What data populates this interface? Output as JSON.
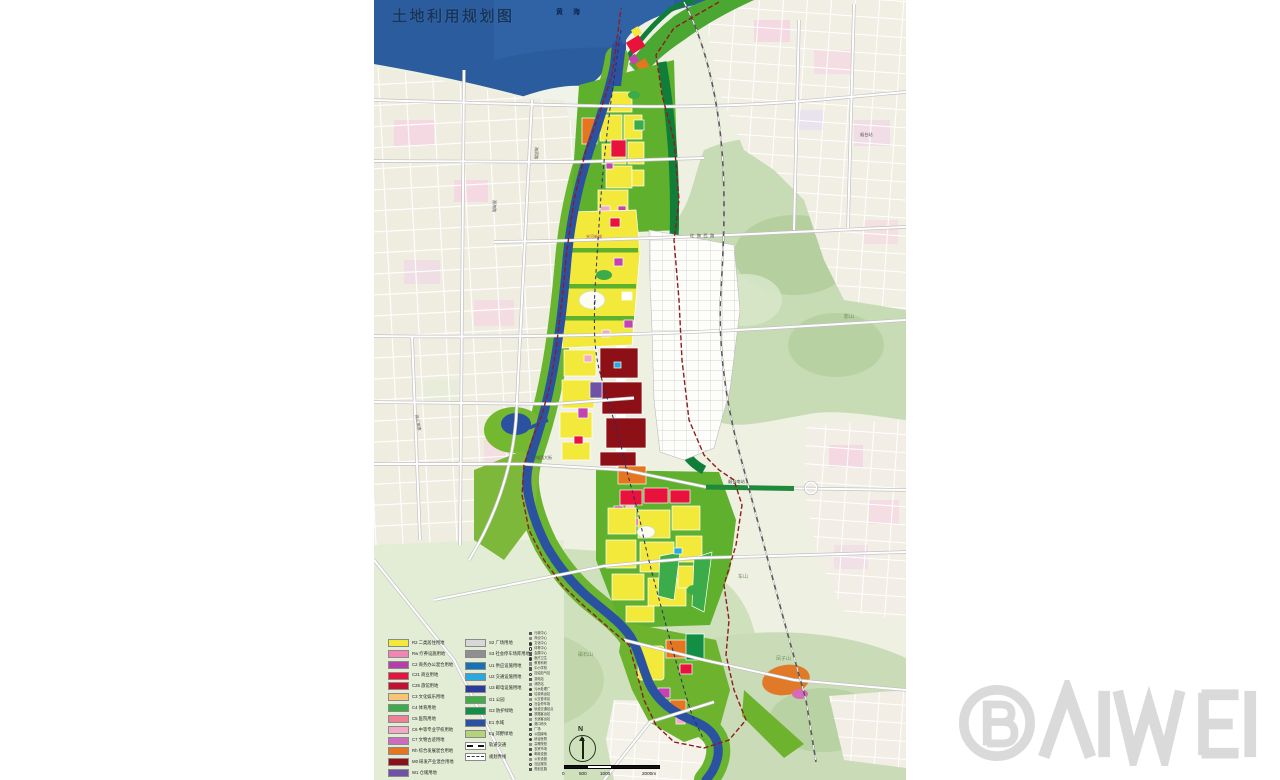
{
  "title": "土地利用规划图",
  "watermark_text": "BAIWEI",
  "north_label": "N",
  "scale": {
    "ticks": [
      {
        "label": "0",
        "left": 6
      },
      {
        "label": "500",
        "left": 23
      },
      {
        "label": "1000",
        "left": 44
      },
      {
        "label": "2000m",
        "left": 86
      }
    ]
  },
  "colors": {
    "sea": "#2b5c9e",
    "river": "#2a52a0",
    "park_green": "#63b22e",
    "boundary_line": "#8f1d1d",
    "watermark_gray": "#d9d9d9"
  },
  "legend": {
    "col1": [
      {
        "label": "R2 二类居住用地",
        "color": "#f2e93b"
      },
      {
        "label": "Rw 疗养设施用地",
        "color": "#f285b4"
      },
      {
        "label": "C2 商务办公混合用地",
        "color": "#b53fa8"
      },
      {
        "label": "C21 商业用地",
        "color": "#e8123d"
      },
      {
        "label": "C25 旅馆用地",
        "color": "#c50f31"
      },
      {
        "label": "C3 文化娱乐用地",
        "color": "#f8c577"
      },
      {
        "label": "C4 体育用地",
        "color": "#3cab49"
      },
      {
        "label": "C5 医院用地",
        "color": "#ec8096"
      },
      {
        "label": "C6 中等专业学校用地",
        "color": "#f2a9c6"
      },
      {
        "label": "C7 文物古迹用地",
        "color": "#cf6bbf"
      },
      {
        "label": "Rh 综合发展混合用地",
        "color": "#e5761f"
      },
      {
        "label": "M0 研发产业混合用地",
        "color": "#8c1016"
      },
      {
        "label": "W1 仓储用地",
        "color": "#6f51a5"
      }
    ],
    "col2": [
      {
        "label": "S2 广场用地",
        "color": "#d8d8d8"
      },
      {
        "label": "S3 社会停车场库用地",
        "color": "#8f8f8f"
      },
      {
        "label": "U1 供应设施用地",
        "color": "#1573b5"
      },
      {
        "label": "U2 交通设施用地",
        "color": "#2aa8e0"
      },
      {
        "label": "U3 邮电设施用地",
        "color": "#2c3a99"
      },
      {
        "label": "G1 公园",
        "color": "#3fae49"
      },
      {
        "label": "G2 防护绿地",
        "color": "#128f45"
      },
      {
        "label": "E1 水域",
        "color": "#2a52a0"
      },
      {
        "label": "Eg 郊野绿地",
        "color": "#b5d378"
      },
      {
        "label": "轨道交通",
        "type": "rail"
      },
      {
        "label": "规划界线",
        "type": "bound"
      }
    ],
    "col3": [
      {
        "label": "行政中心",
        "shape": "sq"
      },
      {
        "label": "商业中心",
        "shape": "sq-gray"
      },
      {
        "label": "文化中心",
        "shape": "ci"
      },
      {
        "label": "体育中心",
        "shape": "ci-open"
      },
      {
        "label": "会展中心",
        "shape": "sq"
      },
      {
        "label": "医疗卫生",
        "shape": "ci"
      },
      {
        "label": "教育科研",
        "shape": "sq-gray"
      },
      {
        "label": "中小学校",
        "shape": "sq"
      },
      {
        "label": "加油加气站",
        "shape": "ci-open"
      },
      {
        "label": "变电站",
        "shape": "sq"
      },
      {
        "label": "消防站",
        "shape": "sq-gray"
      },
      {
        "label": "污水处理厂",
        "shape": "ci"
      },
      {
        "label": "垃圾转运站",
        "shape": "sq"
      },
      {
        "label": "公交首末站",
        "shape": "sq-gray"
      },
      {
        "label": "社会停车场",
        "shape": "ci-open"
      },
      {
        "label": "轨道交通站点",
        "shape": "ci"
      },
      {
        "label": "铁路客运站",
        "shape": "sq"
      },
      {
        "label": "长途客运站",
        "shape": "sq-gray"
      },
      {
        "label": "港口码头",
        "shape": "ci"
      },
      {
        "label": "广场",
        "shape": "sq"
      },
      {
        "label": "公园绿地",
        "shape": "ci-open"
      },
      {
        "label": "综合医院",
        "shape": "ci"
      },
      {
        "label": "高等院校",
        "shape": "sq-gray"
      },
      {
        "label": "农贸市场",
        "shape": "sq"
      },
      {
        "label": "邮政设施",
        "shape": "ci"
      },
      {
        "label": "公安设施",
        "shape": "sq-gray"
      },
      {
        "label": "社区服务",
        "shape": "ci-open"
      },
      {
        "label": "规划支路",
        "shape": "sq"
      }
    ]
  },
  "map_labels": [
    {
      "text": "黄  海",
      "x": 182,
      "y": 14,
      "size": 7,
      "color": "#0d2a4d",
      "ls": 4,
      "bold": true
    },
    {
      "text": "夹河新城",
      "x": 212,
      "y": 238,
      "size": 4,
      "color": "#a84a7e"
    },
    {
      "text": "红旗西路",
      "x": 316,
      "y": 237,
      "size": 4.2,
      "color": "#4a4a4a",
      "ls": 2.5
    },
    {
      "text": "烟台站",
      "x": 486,
      "y": 136,
      "size": 4.2,
      "color": "#555555"
    },
    {
      "text": "烟台南站",
      "x": 354,
      "y": 483,
      "size": 4.2,
      "color": "#444444"
    },
    {
      "text": "影山",
      "x": 470,
      "y": 318,
      "size": 5,
      "color": "#70905e"
    },
    {
      "text": "车山",
      "x": 364,
      "y": 578,
      "size": 5,
      "color": "#70905e"
    },
    {
      "text": "凤子山",
      "x": 402,
      "y": 660,
      "size": 5,
      "color": "#70905e"
    },
    {
      "text": "磁石山",
      "x": 204,
      "y": 656,
      "size": 5,
      "color": "#70905e"
    },
    {
      "text": "海滨路",
      "x": 161,
      "y": 147,
      "size": 4,
      "color": "#555555",
      "rotate": 90
    },
    {
      "text": "观海路",
      "x": 119,
      "y": 200,
      "size": 4,
      "color": "#555555",
      "rotate": 90
    },
    {
      "text": "港城西大街",
      "x": 158,
      "y": 459,
      "size": 4,
      "color": "#555555"
    },
    {
      "text": "同三高速",
      "x": 41,
      "y": 415,
      "size": 4,
      "color": "#555555",
      "rotate": 78
    }
  ]
}
